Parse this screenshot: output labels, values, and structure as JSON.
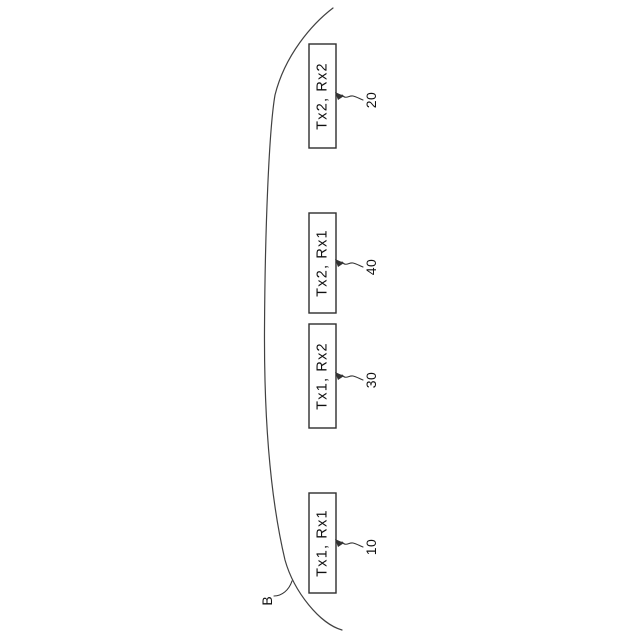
{
  "figure": {
    "kind": "patent-style rotated diagram",
    "boundary": {
      "label": "B"
    },
    "units": [
      {
        "label": "Tx2, Rx2",
        "ref": "20"
      },
      {
        "label": "Tx2, Rx1",
        "ref": "40"
      },
      {
        "label": "Tx1, Rx2",
        "ref": "30"
      },
      {
        "label": "Tx1, Rx1",
        "ref": "10"
      }
    ],
    "colors": {
      "background": "#ffffff",
      "line": "#414141",
      "box_stroke": "#2e2e2e",
      "text": "#111111"
    }
  }
}
